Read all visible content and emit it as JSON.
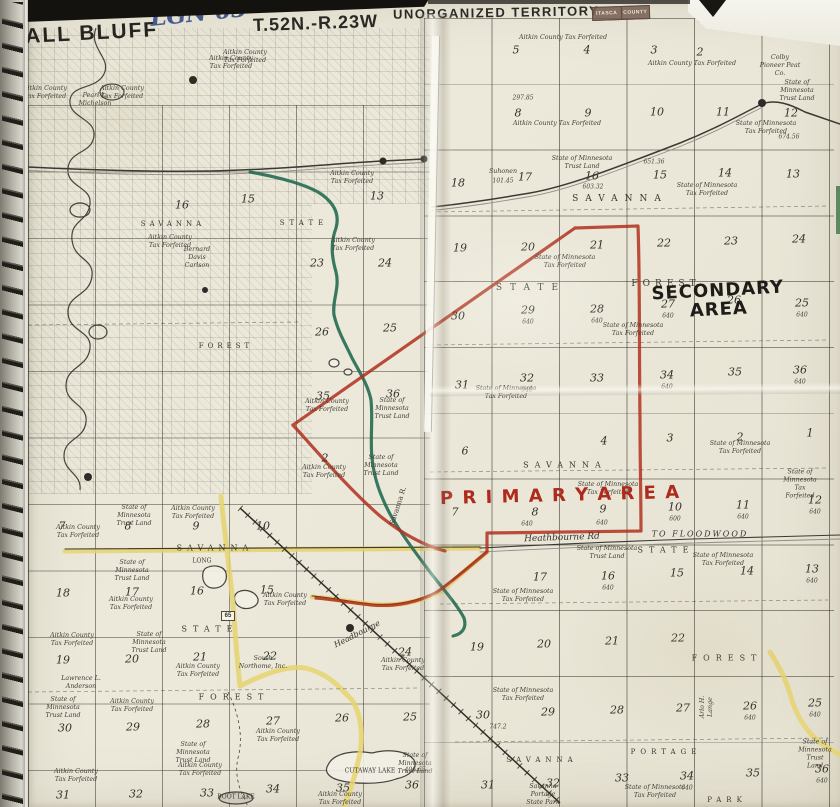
{
  "header": {
    "map_title": "BALL BLUFF",
    "handwritten_note": "LGN 63",
    "township_left": "T.52N.-R.23W",
    "territory": "UNORGANIZED TERRITORY",
    "township_right": "T.52N.-R.22W",
    "stamp_line1": "ITASCA",
    "stamp_line2": "COUNTY",
    "page_number": "72",
    "side_note": "SEE PAGE"
  },
  "annotations": {
    "primary": "P R I M A R Y   A R E A",
    "secondary": "SECONDARY\nAREA",
    "highway_marker": "65"
  },
  "colors": {
    "paper": "#eae7d8",
    "ink": "#35332e",
    "marker_red": "#b1301f",
    "marker_green": "#256b52",
    "road_yellow": "#e6d36e",
    "pen_blue": "#44598d"
  },
  "layers": {
    "section_number": [
      {
        "t": "5",
        "x": 516,
        "y": 50
      },
      {
        "t": "4",
        "x": 587,
        "y": 50
      },
      {
        "t": "3",
        "x": 654,
        "y": 50
      },
      {
        "t": "2",
        "x": 700,
        "y": 52
      },
      {
        "t": "8",
        "x": 518,
        "y": 113
      },
      {
        "t": "9",
        "x": 588,
        "y": 113
      },
      {
        "t": "10",
        "x": 657,
        "y": 112
      },
      {
        "t": "11",
        "x": 723,
        "y": 112
      },
      {
        "t": "12",
        "x": 791,
        "y": 113
      },
      {
        "t": "18",
        "x": 458,
        "y": 183
      },
      {
        "t": "17",
        "x": 525,
        "y": 177
      },
      {
        "t": "16",
        "x": 592,
        "y": 176
      },
      {
        "t": "15",
        "x": 660,
        "y": 175
      },
      {
        "t": "14",
        "x": 725,
        "y": 173
      },
      {
        "t": "13",
        "x": 793,
        "y": 174
      },
      {
        "t": "19",
        "x": 460,
        "y": 248
      },
      {
        "t": "20",
        "x": 528,
        "y": 247
      },
      {
        "t": "21",
        "x": 597,
        "y": 245
      },
      {
        "t": "22",
        "x": 664,
        "y": 243
      },
      {
        "t": "23",
        "x": 731,
        "y": 241
      },
      {
        "t": "24",
        "x": 799,
        "y": 239
      },
      {
        "t": "30",
        "x": 458,
        "y": 316
      },
      {
        "t": "29",
        "x": 528,
        "y": 310
      },
      {
        "t": "28",
        "x": 597,
        "y": 309
      },
      {
        "t": "27",
        "x": 668,
        "y": 304
      },
      {
        "t": "26",
        "x": 734,
        "y": 300
      },
      {
        "t": "25",
        "x": 802,
        "y": 303
      },
      {
        "t": "31",
        "x": 462,
        "y": 385
      },
      {
        "t": "32",
        "x": 527,
        "y": 378
      },
      {
        "t": "33",
        "x": 597,
        "y": 378
      },
      {
        "t": "34",
        "x": 667,
        "y": 375
      },
      {
        "t": "35",
        "x": 735,
        "y": 372
      },
      {
        "t": "36",
        "x": 800,
        "y": 370
      },
      {
        "t": "6",
        "x": 465,
        "y": 451
      },
      {
        "t": "4",
        "x": 604,
        "y": 441
      },
      {
        "t": "3",
        "x": 670,
        "y": 438
      },
      {
        "t": "2",
        "x": 740,
        "y": 437
      },
      {
        "t": "1",
        "x": 810,
        "y": 433
      },
      {
        "t": "7",
        "x": 455,
        "y": 512
      },
      {
        "t": "8",
        "x": 535,
        "y": 512
      },
      {
        "t": "9",
        "x": 603,
        "y": 509
      },
      {
        "t": "10",
        "x": 675,
        "y": 507
      },
      {
        "t": "11",
        "x": 743,
        "y": 505
      },
      {
        "t": "12",
        "x": 815,
        "y": 500
      },
      {
        "t": "17",
        "x": 540,
        "y": 577
      },
      {
        "t": "16",
        "x": 608,
        "y": 576
      },
      {
        "t": "15",
        "x": 677,
        "y": 573
      },
      {
        "t": "14",
        "x": 747,
        "y": 571
      },
      {
        "t": "13",
        "x": 812,
        "y": 569
      },
      {
        "t": "19",
        "x": 477,
        "y": 647
      },
      {
        "t": "20",
        "x": 544,
        "y": 644
      },
      {
        "t": "21",
        "x": 612,
        "y": 641
      },
      {
        "t": "22",
        "x": 678,
        "y": 638
      },
      {
        "t": "30",
        "x": 483,
        "y": 715
      },
      {
        "t": "29",
        "x": 548,
        "y": 712
      },
      {
        "t": "28",
        "x": 617,
        "y": 710
      },
      {
        "t": "27",
        "x": 683,
        "y": 708
      },
      {
        "t": "26",
        "x": 750,
        "y": 706
      },
      {
        "t": "25",
        "x": 815,
        "y": 703
      },
      {
        "t": "31",
        "x": 488,
        "y": 785
      },
      {
        "t": "32",
        "x": 553,
        "y": 783
      },
      {
        "t": "33",
        "x": 622,
        "y": 778
      },
      {
        "t": "34",
        "x": 687,
        "y": 776
      },
      {
        "t": "35",
        "x": 753,
        "y": 773
      },
      {
        "t": "36",
        "x": 822,
        "y": 769
      },
      {
        "t": "16",
        "x": 182,
        "y": 205
      },
      {
        "t": "15",
        "x": 248,
        "y": 199
      },
      {
        "t": "13",
        "x": 377,
        "y": 196
      },
      {
        "t": "23",
        "x": 317,
        "y": 263
      },
      {
        "t": "24",
        "x": 385,
        "y": 263
      },
      {
        "t": "26",
        "x": 322,
        "y": 332
      },
      {
        "t": "25",
        "x": 390,
        "y": 328
      },
      {
        "t": "35",
        "x": 323,
        "y": 396
      },
      {
        "t": "36",
        "x": 393,
        "y": 394
      },
      {
        "t": "2",
        "x": 325,
        "y": 458
      },
      {
        "t": "7",
        "x": 62,
        "y": 526
      },
      {
        "t": "8",
        "x": 128,
        "y": 526
      },
      {
        "t": "9",
        "x": 196,
        "y": 526
      },
      {
        "t": "10",
        "x": 263,
        "y": 526
      },
      {
        "t": "18",
        "x": 63,
        "y": 593
      },
      {
        "t": "17",
        "x": 132,
        "y": 592
      },
      {
        "t": "16",
        "x": 197,
        "y": 591
      },
      {
        "t": "15",
        "x": 267,
        "y": 590
      },
      {
        "t": "19",
        "x": 63,
        "y": 660
      },
      {
        "t": "20",
        "x": 132,
        "y": 659
      },
      {
        "t": "21",
        "x": 200,
        "y": 657
      },
      {
        "t": "22",
        "x": 270,
        "y": 656
      },
      {
        "t": "24",
        "x": 405,
        "y": 652
      },
      {
        "t": "30",
        "x": 65,
        "y": 728
      },
      {
        "t": "29",
        "x": 133,
        "y": 727
      },
      {
        "t": "28",
        "x": 203,
        "y": 724
      },
      {
        "t": "27",
        "x": 273,
        "y": 721
      },
      {
        "t": "26",
        "x": 342,
        "y": 718
      },
      {
        "t": "25",
        "x": 410,
        "y": 717
      },
      {
        "t": "31",
        "x": 63,
        "y": 795
      },
      {
        "t": "32",
        "x": 136,
        "y": 794
      },
      {
        "t": "33",
        "x": 207,
        "y": 793
      },
      {
        "t": "34",
        "x": 273,
        "y": 789
      },
      {
        "t": "35",
        "x": 343,
        "y": 788
      },
      {
        "t": "36",
        "x": 412,
        "y": 785
      }
    ],
    "acreage_note": [
      {
        "t": "297.85",
        "x": 523,
        "y": 98
      },
      {
        "t": "674.56",
        "x": 789,
        "y": 137
      },
      {
        "t": "651.36",
        "x": 654,
        "y": 162
      },
      {
        "t": "603.32",
        "x": 593,
        "y": 187
      },
      {
        "t": "101.45",
        "x": 503,
        "y": 181
      },
      {
        "t": "640",
        "x": 528,
        "y": 322
      },
      {
        "t": "640",
        "x": 597,
        "y": 321
      },
      {
        "t": "640",
        "x": 668,
        "y": 316
      },
      {
        "t": "640",
        "x": 802,
        "y": 315
      },
      {
        "t": "640",
        "x": 527,
        "y": 390
      },
      {
        "t": "640",
        "x": 667,
        "y": 387
      },
      {
        "t": "640",
        "x": 800,
        "y": 382
      },
      {
        "t": "640",
        "x": 527,
        "y": 524
      },
      {
        "t": "640",
        "x": 602,
        "y": 523
      },
      {
        "t": "600",
        "x": 675,
        "y": 519
      },
      {
        "t": "640",
        "x": 743,
        "y": 517
      },
      {
        "t": "640",
        "x": 815,
        "y": 512
      },
      {
        "t": "640",
        "x": 608,
        "y": 588
      },
      {
        "t": "640",
        "x": 812,
        "y": 581
      },
      {
        "t": "747.2",
        "x": 498,
        "y": 727
      },
      {
        "t": "640",
        "x": 750,
        "y": 718
      },
      {
        "t": "640",
        "x": 815,
        "y": 715
      },
      {
        "t": "640",
        "x": 687,
        "y": 788
      },
      {
        "t": "640",
        "x": 822,
        "y": 781
      },
      {
        "t": "406.65",
        "x": 415,
        "y": 770
      }
    ],
    "place_name": [
      {
        "t": "SAVANNA",
        "x": 173,
        "y": 224,
        "s": 7,
        "sp": 4
      },
      {
        "t": "STATE",
        "x": 304,
        "y": 223,
        "s": 7,
        "sp": 5
      },
      {
        "t": "FOREST",
        "x": 226,
        "y": 346,
        "s": 7,
        "sp": 4
      },
      {
        "t": "SAVANNA",
        "x": 620,
        "y": 199,
        "s": 9,
        "sp": 7
      },
      {
        "t": "STATE",
        "x": 531,
        "y": 288,
        "s": 9,
        "sp": 8
      },
      {
        "t": "FOREST",
        "x": 666,
        "y": 284,
        "s": 9,
        "sp": 5
      },
      {
        "t": "SAVANNA",
        "x": 565,
        "y": 465,
        "s": 8,
        "sp": 6
      },
      {
        "t": "STATE",
        "x": 666,
        "y": 550,
        "s": 8,
        "sp": 6
      },
      {
        "t": "FOREST",
        "x": 727,
        "y": 658,
        "s": 8,
        "sp": 6
      },
      {
        "t": "SAVANNA",
        "x": 215,
        "y": 548,
        "s": 8,
        "sp": 5
      },
      {
        "t": "STATE",
        "x": 210,
        "y": 629,
        "s": 8,
        "sp": 6
      },
      {
        "t": "FOREST",
        "x": 234,
        "y": 697,
        "s": 8,
        "sp": 6
      },
      {
        "t": "SAVANNA",
        "x": 542,
        "y": 760,
        "s": 7,
        "sp": 5
      },
      {
        "t": "PORTAGE",
        "x": 666,
        "y": 752,
        "s": 7,
        "sp": 5
      },
      {
        "t": "PARK",
        "x": 727,
        "y": 800,
        "s": 7,
        "sp": 5
      },
      {
        "t": "CUTAWAY LAKE",
        "x": 370,
        "y": 771,
        "s": 6
      },
      {
        "t": "LONG",
        "x": 202,
        "y": 561,
        "s": 6
      },
      {
        "t": "BOOT LAKE",
        "x": 236,
        "y": 797,
        "s": 6
      },
      {
        "t": "Savanna R.",
        "x": 398,
        "y": 506,
        "s": 7,
        "r": -72
      }
    ],
    "ownership_label": [
      {
        "t": "Aitkin County Tax Forfeited",
        "x": 563,
        "y": 38
      },
      {
        "t": "Aitkin County Tax Forfeited",
        "x": 692,
        "y": 64
      },
      {
        "t": "Aitkin County Tax Forfeited",
        "x": 557,
        "y": 124
      },
      {
        "t": "State of Minnesota\nTax Forfeited",
        "x": 766,
        "y": 128
      },
      {
        "t": "State of Minnesota\nTax Forfeited",
        "x": 707,
        "y": 190
      },
      {
        "t": "State of Minnesota\nTrust Land",
        "x": 582,
        "y": 163
      },
      {
        "t": "Suhonen",
        "x": 503,
        "y": 172
      },
      {
        "t": "State of Minnesota\nTax Forfeited",
        "x": 565,
        "y": 262
      },
      {
        "t": "State of Minnesota\nTax Forfeited",
        "x": 633,
        "y": 330
      },
      {
        "t": "State of Minnesota\nTax Forfeited",
        "x": 506,
        "y": 393
      },
      {
        "t": "State of Minnesota\nTax Forfeited",
        "x": 740,
        "y": 448
      },
      {
        "t": "State of Minnesota\nTax Forfeited",
        "x": 800,
        "y": 484
      },
      {
        "t": "Aitkin County\nTax Forfeited",
        "x": 352,
        "y": 178
      },
      {
        "t": "Aitkin County\nTax Forfeited",
        "x": 353,
        "y": 245
      },
      {
        "t": "Aitkin County\nTax Forfeited",
        "x": 245,
        "y": 57
      },
      {
        "t": "Aitkin County\nTax Forfeited",
        "x": 170,
        "y": 242
      },
      {
        "t": "Bernard\nDavis\nCarlson",
        "x": 197,
        "y": 258
      },
      {
        "t": "Aitkin County\nTax Forfeited",
        "x": 45,
        "y": 93
      },
      {
        "t": "Aitkin County\nTax Forfeited",
        "x": 122,
        "y": 93
      },
      {
        "t": "Aitkin County\nTax Forfeited",
        "x": 231,
        "y": 63
      },
      {
        "t": "Pearl L.\nMichelson",
        "x": 95,
        "y": 100
      },
      {
        "t": "State of Minnesota\nTax Forfeited",
        "x": 608,
        "y": 489
      },
      {
        "t": "State of Minnesota\nTrust Land",
        "x": 607,
        "y": 553
      },
      {
        "t": "State of Minnesota\nTax Forfeited",
        "x": 723,
        "y": 560
      },
      {
        "t": "State of\nMinnesota\nTrust Land",
        "x": 134,
        "y": 516
      },
      {
        "t": "State of\nMinnesota\nTrust Land",
        "x": 132,
        "y": 571
      },
      {
        "t": "Aitkin County\nTax Forfeited",
        "x": 78,
        "y": 532
      },
      {
        "t": "Aitkin County\nTax Forfeited",
        "x": 131,
        "y": 604
      },
      {
        "t": "Aitkin County\nTax Forfeited",
        "x": 285,
        "y": 600
      },
      {
        "t": "Aitkin County\nTax Forfeited",
        "x": 193,
        "y": 513
      },
      {
        "t": "Aitkin County\nTax Forfeited",
        "x": 403,
        "y": 665
      },
      {
        "t": "State of Minnesota\nTax Forfeited",
        "x": 523,
        "y": 596
      },
      {
        "t": "State of Minnesota\nTax Forfeited",
        "x": 523,
        "y": 695
      },
      {
        "t": "Aitkin County\nTax Forfeited",
        "x": 72,
        "y": 640
      },
      {
        "t": "State of\nMinnesota\nTrust Land",
        "x": 149,
        "y": 643
      },
      {
        "t": "Aitkin County\nTax Forfeited",
        "x": 198,
        "y": 671
      },
      {
        "t": "Aitkin County\nTax Forfeited",
        "x": 132,
        "y": 706
      },
      {
        "t": "State of\nMinnesota\nTrust Land",
        "x": 63,
        "y": 708
      },
      {
        "t": "State of\nMinnesota\nTrust Land",
        "x": 193,
        "y": 753
      },
      {
        "t": "Aitkin County\nTax Forfeited",
        "x": 76,
        "y": 776
      },
      {
        "t": "Aitkin County\nTax Forfeited",
        "x": 200,
        "y": 770
      },
      {
        "t": "Aitkin County\nTax Forfeited",
        "x": 278,
        "y": 736
      },
      {
        "t": "State of\nMinnesota\nTrust Land",
        "x": 415,
        "y": 764
      },
      {
        "t": "Aitkin County\nTax Forfeited",
        "x": 340,
        "y": 799
      },
      {
        "t": "Savanna\nPortage\nState Park",
        "x": 543,
        "y": 795
      },
      {
        "t": "State of Minnesota\nTax Forfeited",
        "x": 655,
        "y": 792
      },
      {
        "t": "State of Minnesota\nTrust Land",
        "x": 815,
        "y": 754
      },
      {
        "t": "Arlo H.\nLange",
        "x": 707,
        "y": 707,
        "r": -90
      },
      {
        "t": "Aitkin County\nTax Forfeited",
        "x": 327,
        "y": 406
      },
      {
        "t": "State of\nMinnesota\nTrust Land",
        "x": 392,
        "y": 409
      },
      {
        "t": "State of\nMinnesota\nTrust Land",
        "x": 381,
        "y": 466
      },
      {
        "t": "Aitkin County\nTax Forfeited",
        "x": 324,
        "y": 472
      },
      {
        "t": "Colby\nPioneer Peat\nCo.",
        "x": 780,
        "y": 66
      },
      {
        "t": "State of\nMinnesota\nTrust Land",
        "x": 797,
        "y": 91
      },
      {
        "t": "South\nNorthome, Inc.",
        "x": 263,
        "y": 663
      },
      {
        "t": "Lawrence L.\nAnderson",
        "x": 81,
        "y": 683
      }
    ],
    "road_label": [
      {
        "t": "Heathbourne Rd",
        "x": 562,
        "y": 538,
        "s": 9,
        "r": -2
      },
      {
        "t": "Headbourne",
        "x": 357,
        "y": 634,
        "s": 8,
        "r": -27
      },
      {
        "t": "TO FLOODWOOD",
        "x": 700,
        "y": 534,
        "s": 8,
        "sp": 2
      }
    ]
  }
}
